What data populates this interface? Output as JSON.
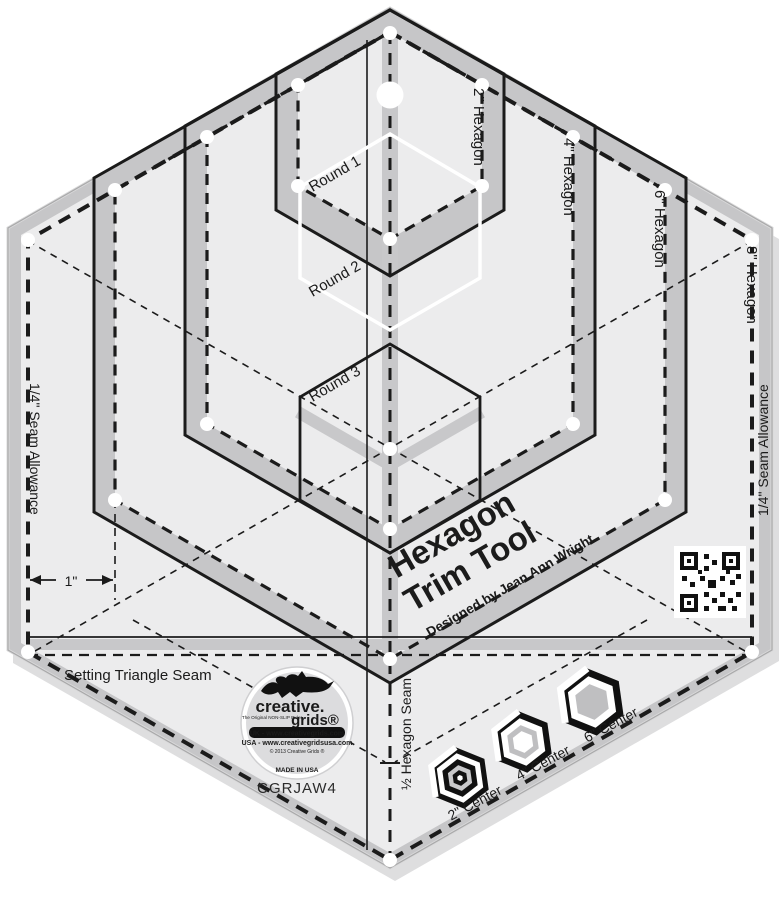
{
  "product": {
    "title_line1": "Hexagon",
    "title_line2": "Trim Tool",
    "byline": "Designed by Jean Ann Wright",
    "sku": "CGRJAW4"
  },
  "markings": {
    "hexagon_sizes": [
      "2\" Hexagon",
      "4\" Hexagon",
      "6\" Hexagon",
      "8\" Hexagon"
    ],
    "rounds": [
      "Round 1",
      "Round 2",
      "Round 3"
    ],
    "seam_allowance_left": "1/4\" Seam Allowance",
    "seam_allowance_right": "1/4\" Seam Allowance",
    "setting_triangle": "Setting Triangle Seam",
    "half_hexagon_seam": "½ Hexagon Seam",
    "one_inch": "1\"",
    "centers": [
      "2\" Center",
      "4\" Center",
      "6\" Center"
    ]
  },
  "logo": {
    "brand_top": "creative.",
    "brand_bottom": "grids®",
    "tagline": "The Original NON-SLIP Ruler",
    "uk": "UK - www.creativegrids.com",
    "usa": "USA - www.creativegridsusa.com",
    "copyright": "© 2013 Creative Grids ®",
    "made_in": "MADE IN USA"
  },
  "colors": {
    "plate": "#ececed",
    "bevel": "#c6c6c8",
    "line": "#1b1b1b",
    "white": "#ffffff"
  }
}
